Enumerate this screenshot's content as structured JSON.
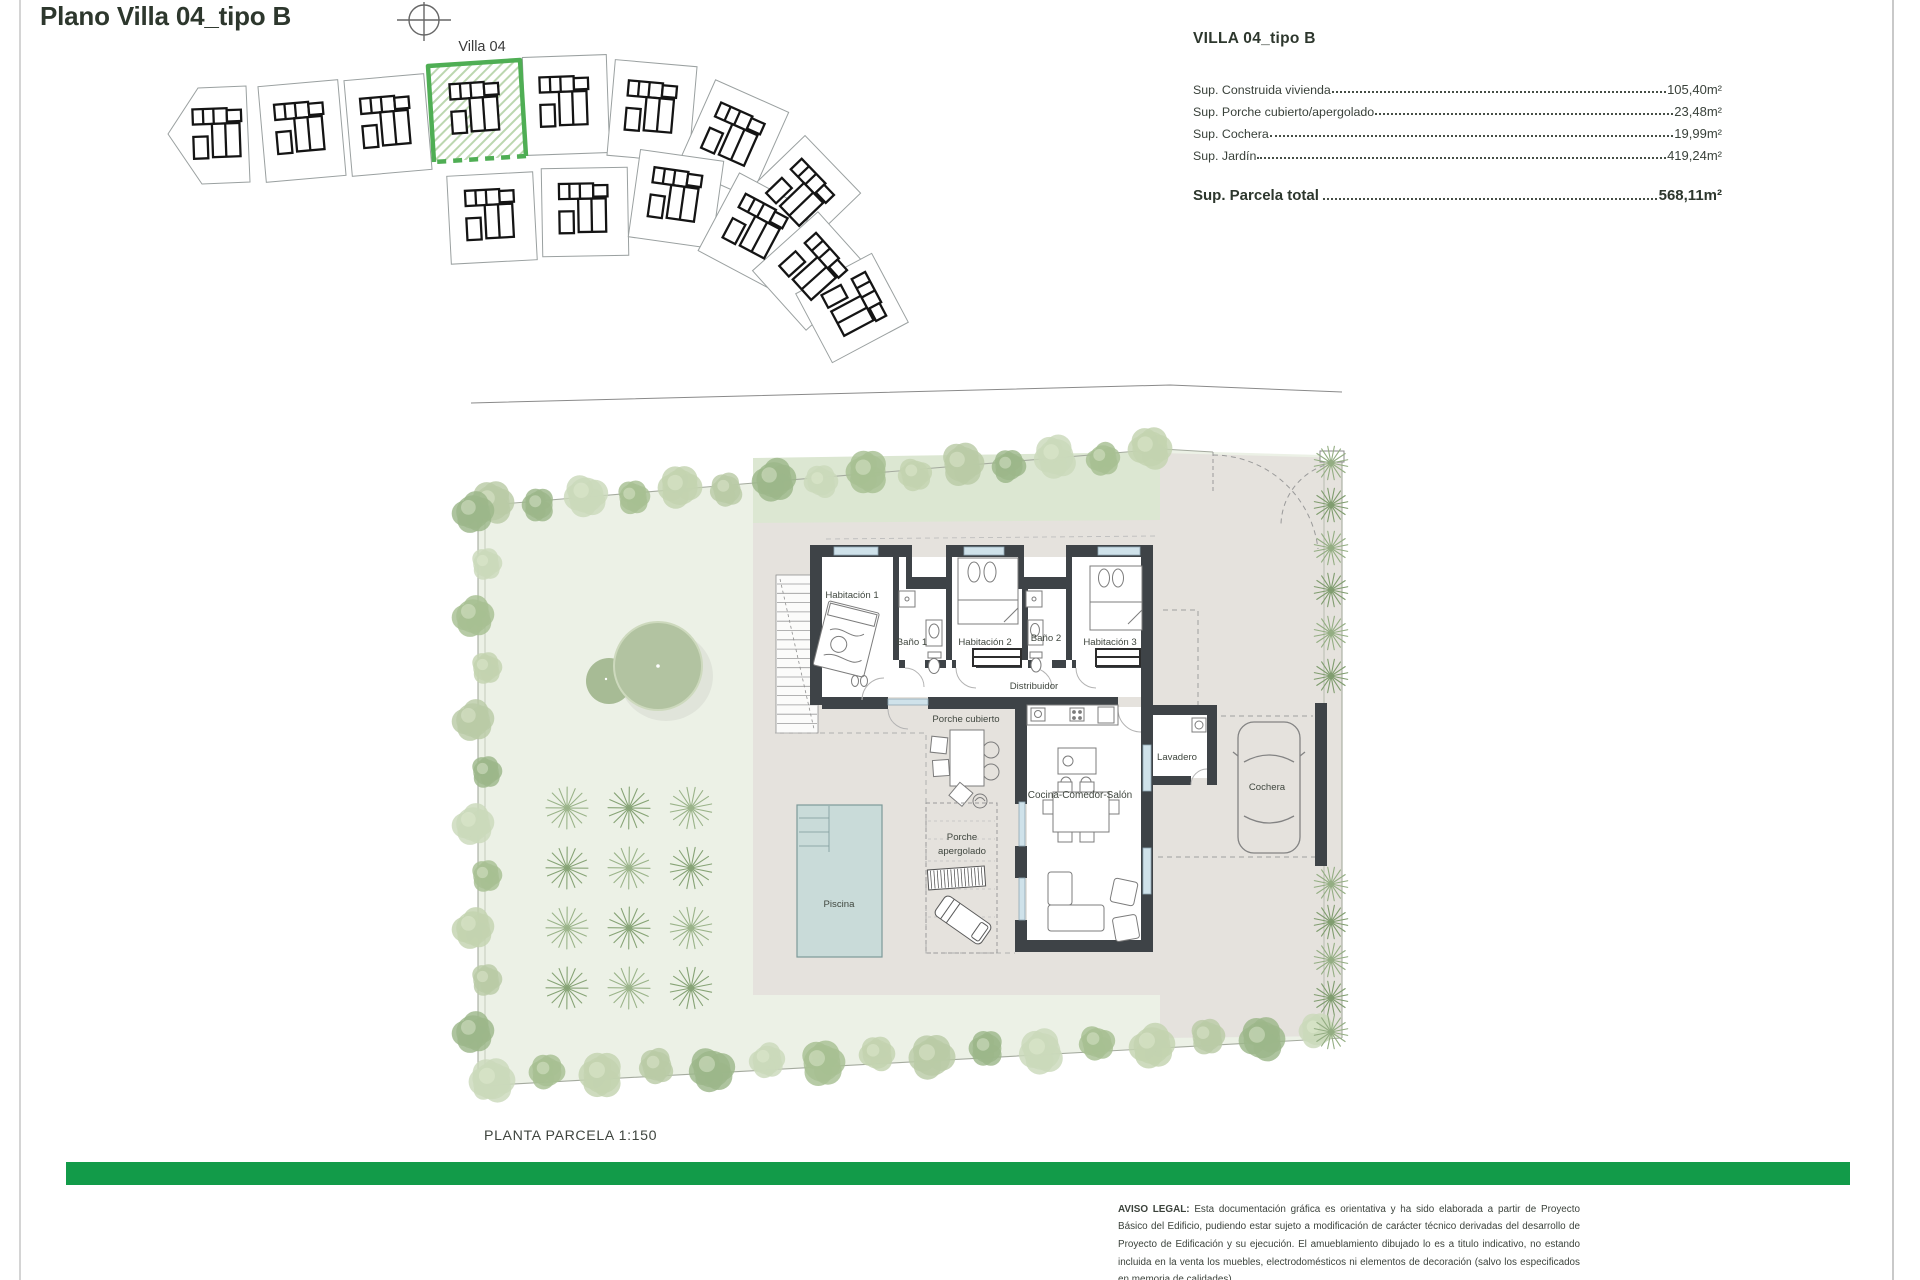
{
  "page": {
    "title": "Plano Villa 04_tipo B"
  },
  "site_plan": {
    "villa_label": "Villa 04"
  },
  "info_panel": {
    "heading": "VILLA 04_tipo B",
    "rows": [
      {
        "label": "Sup. Construida vivienda",
        "value": "105,40m²"
      },
      {
        "label": "Sup. Porche cubierto/apergolado",
        "value": "23,48m²"
      },
      {
        "label": "Sup. Cochera",
        "value": "19,99m²"
      },
      {
        "label": "Sup. Jardín",
        "value": "419,24m²"
      }
    ],
    "total": {
      "label": "Sup. Parcela total",
      "value": "568,11m²"
    }
  },
  "plan": {
    "rooms": {
      "habitacion1": "Habitación 1",
      "bano1": "Baño 1",
      "habitacion2": "Habitación 2",
      "bano2": "Baño 2",
      "habitacion3": "Habitación 3",
      "distribuidor": "Distribuidor",
      "porche_cubierto": "Porche cubierto",
      "cocina": "Cocina-Comedor-Salón",
      "porche_apergolado_l1": "Porche",
      "porche_apergolado_l2": "apergolado",
      "piscina": "Piscina",
      "lavadero": "Lavadero",
      "cochera": "Cochera"
    },
    "scale_label": "PLANTA PARCELA 1:150"
  },
  "legal": {
    "title": "AVISO LEGAL:",
    "text": " Esta documentación gráfica es orientativa y ha sido elaborada a partir de Proyecto Básico del Edificio, pudiendo estar sujeto a modificación de carácter técnico derivadas del desarrollo de Proyecto de Edificación y su ejecución. El amueblamiento dibujado lo es a titulo indicativo, no estando incluida en la venta los muebles, electrodomésticos ni elementos de decoración (salvo los especificados en memoria de calidades)"
  },
  "colors": {
    "accent_green_bar": "#129b49",
    "highlight_plot_green": "#4fae54",
    "heading_green": "#2d372d"
  }
}
